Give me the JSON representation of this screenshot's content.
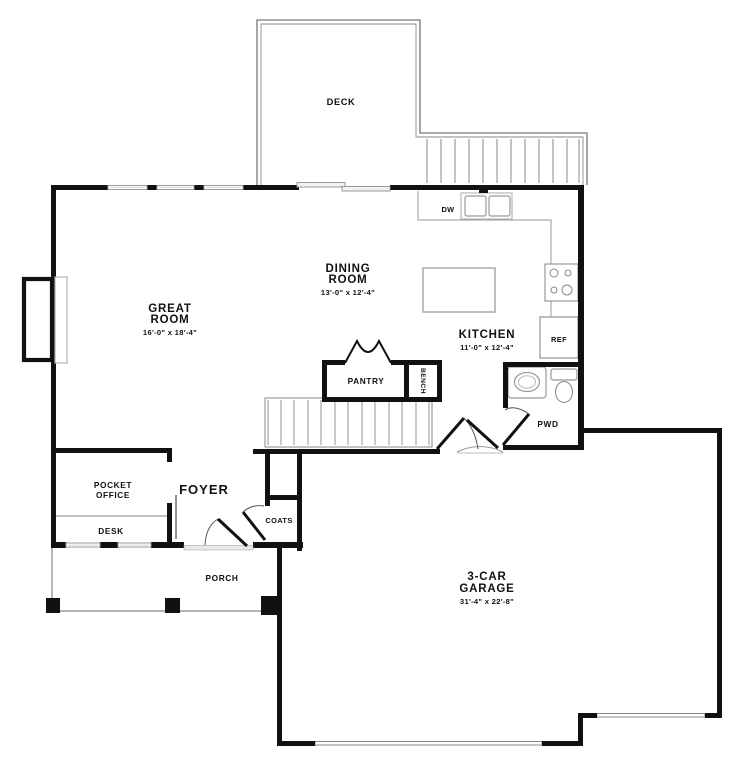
{
  "title": "First Floor Plan",
  "colors": {
    "wall": "#111111",
    "thin_line": "#9a9a9a",
    "label": "#111111",
    "background": "#ffffff"
  },
  "rooms": {
    "deck": {
      "name": "DECK"
    },
    "great_room": {
      "line1": "GREAT",
      "line2": "ROOM",
      "dims": "16'-0\" x 18'-4\""
    },
    "dining_room": {
      "line1": "DINING",
      "line2": "ROOM",
      "dims": "13'-0\" x 12'-4\""
    },
    "kitchen": {
      "name": "KITCHEN",
      "dims": "11'-0\" x 12'-4\""
    },
    "pantry": {
      "name": "PANTRY"
    },
    "bench": {
      "name": "BENCH"
    },
    "powder_room": {
      "name": "PWD"
    },
    "pocket_office": {
      "line1": "POCKET",
      "line2": "OFFICE"
    },
    "desk": {
      "name": "DESK"
    },
    "foyer": {
      "name": "FOYER"
    },
    "coats": {
      "name": "COATS"
    },
    "porch": {
      "name": "PORCH"
    },
    "garage": {
      "line1": "3-CAR",
      "line2": "GARAGE",
      "dims": "31'-4\" x 22'-8\""
    }
  },
  "appliances": {
    "dishwasher": "DW",
    "refrigerator": "REF"
  }
}
